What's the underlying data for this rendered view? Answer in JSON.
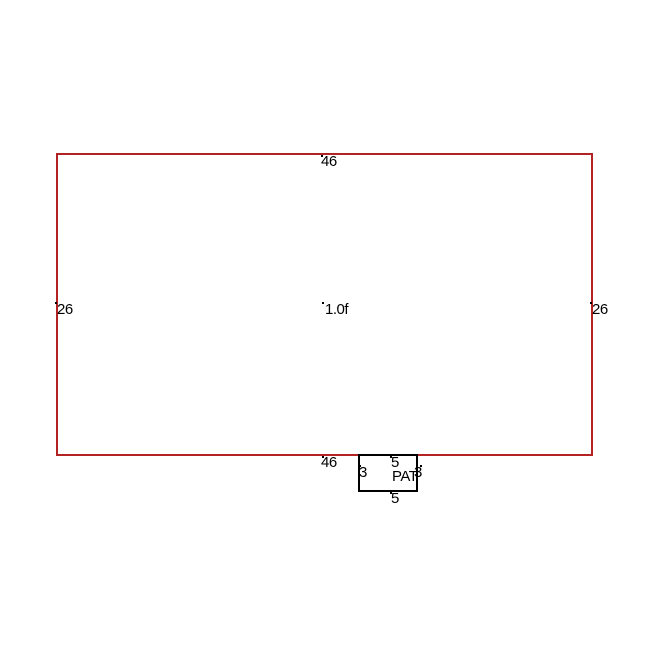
{
  "sketch": {
    "colors": {
      "outline_red": "#b42323",
      "outline_black": "#000000",
      "background": "#ffffff",
      "text": "#000000"
    },
    "main_area": {
      "top_dim": "46",
      "bottom_dim": "46",
      "left_dim": "26",
      "right_dim": "26",
      "center_label": "1.0f"
    },
    "patio": {
      "name": "PAT",
      "top_dim": "5",
      "bottom_dim": "5",
      "left_dim": "3",
      "right_dim": "3"
    }
  }
}
